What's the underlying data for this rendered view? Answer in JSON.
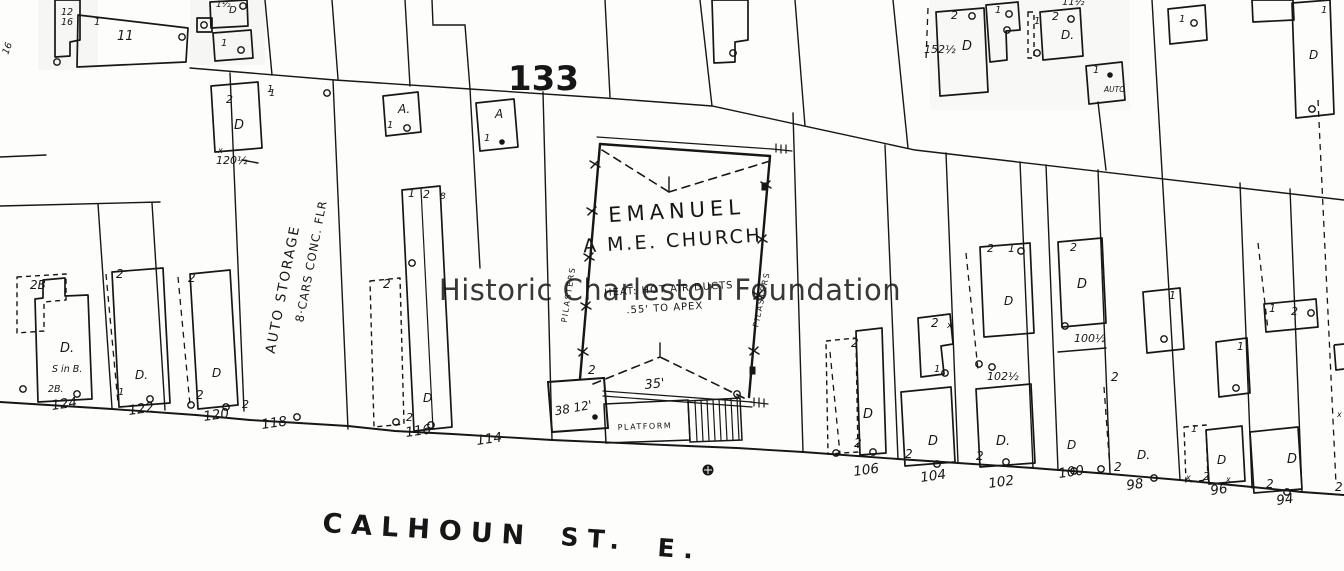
{
  "ink_color": "#161616",
  "watermark": {
    "text": "Historic Charleston Foundation",
    "color": "#8b9097"
  },
  "block_number": "133",
  "street": {
    "name": "CALHOUN",
    "abbrev": "ST.",
    "direction": "E."
  },
  "church": {
    "line1": "EMANUEL",
    "line2": "A M.E. CHURCH",
    "note1": "HEAT: HOT AIR DUCTS",
    "note2": ".55' TO APEX",
    "front_dim": "35'",
    "rear_building_dim": "38 12'",
    "platform_label": "PLATFORM",
    "wall_label_left": "PILASTERS",
    "wall_label_right": "PILASTERS",
    "porch_note": "2"
  },
  "auto_storage": {
    "line1": "AUTO STORAGE",
    "line2": "8·CARS CONC. FLR"
  },
  "street_numbers": [
    {
      "text": "124",
      "x": 52,
      "y": 410
    },
    {
      "text": "122",
      "x": 129,
      "y": 415
    },
    {
      "text": "120",
      "x": 204,
      "y": 421
    },
    {
      "text": "118",
      "x": 262,
      "y": 429
    },
    {
      "text": "116",
      "x": 406,
      "y": 437
    },
    {
      "text": "114",
      "x": 477,
      "y": 445
    },
    {
      "text": "106",
      "x": 854,
      "y": 476
    },
    {
      "text": "104",
      "x": 921,
      "y": 482
    },
    {
      "text": "102",
      "x": 989,
      "y": 488
    },
    {
      "text": "100",
      "x": 1059,
      "y": 478
    },
    {
      "text": "98",
      "x": 1127,
      "y": 490
    },
    {
      "text": "96",
      "x": 1211,
      "y": 495
    },
    {
      "text": "94",
      "x": 1277,
      "y": 505
    }
  ],
  "lot_labels": [
    {
      "text": "2B",
      "x": 30,
      "y": 289,
      "fs": 12
    },
    {
      "text": "D.",
      "x": 60,
      "y": 352,
      "fs": 13
    },
    {
      "text": "S in B.",
      "x": 52,
      "y": 372,
      "fs": 9.5
    },
    {
      "text": "2B.",
      "x": 48,
      "y": 392,
      "fs": 9.5
    },
    {
      "text": "2",
      "x": 116,
      "y": 278,
      "fs": 12
    },
    {
      "text": "2",
      "x": 188,
      "y": 282,
      "fs": 12
    },
    {
      "text": "D.",
      "x": 135,
      "y": 379,
      "fs": 12
    },
    {
      "text": "1",
      "x": 118,
      "y": 395,
      "fs": 10
    },
    {
      "text": "D",
      "x": 212,
      "y": 377,
      "fs": 12
    },
    {
      "text": "2",
      "x": 196,
      "y": 399,
      "fs": 12
    },
    {
      "text": "2",
      "x": 242,
      "y": 408,
      "fs": 11
    },
    {
      "text": "1",
      "x": 267,
      "y": 92,
      "fs": 10
    },
    {
      "text": "A.",
      "x": 398,
      "y": 113,
      "fs": 12
    },
    {
      "text": "1",
      "x": 387,
      "y": 128,
      "fs": 10
    },
    {
      "text": "A",
      "x": 495,
      "y": 118,
      "fs": 12
    },
    {
      "text": "1",
      "x": 484,
      "y": 141,
      "fs": 10
    },
    {
      "text": "1",
      "x": 408,
      "y": 197,
      "fs": 11
    },
    {
      "text": "2",
      "x": 423,
      "y": 198,
      "fs": 11
    },
    {
      "text": "8",
      "x": 440,
      "y": 199,
      "fs": 9
    },
    {
      "text": "2",
      "x": 383,
      "y": 288,
      "fs": 12
    },
    {
      "text": "D",
      "x": 423,
      "y": 402,
      "fs": 12
    },
    {
      "text": "2",
      "x": 406,
      "y": 421,
      "fs": 11
    },
    {
      "text": "2",
      "x": 851,
      "y": 347,
      "fs": 12
    },
    {
      "text": "D",
      "x": 863,
      "y": 418,
      "fs": 13
    },
    {
      "text": "2",
      "x": 854,
      "y": 447,
      "fs": 12
    },
    {
      "text": "2",
      "x": 931,
      "y": 327,
      "fs": 12
    },
    {
      "text": "x",
      "x": 947,
      "y": 328,
      "fs": 9
    },
    {
      "text": "1",
      "x": 934,
      "y": 372,
      "fs": 10
    },
    {
      "text": "D",
      "x": 928,
      "y": 445,
      "fs": 13
    },
    {
      "text": "2",
      "x": 905,
      "y": 458,
      "fs": 12
    },
    {
      "text": "2",
      "x": 987,
      "y": 252,
      "fs": 11
    },
    {
      "text": "1",
      "x": 1008,
      "y": 252,
      "fs": 11
    },
    {
      "text": "D",
      "x": 1004,
      "y": 305,
      "fs": 12
    },
    {
      "text": "102½",
      "x": 987,
      "y": 380,
      "fs": 11
    },
    {
      "text": "D.",
      "x": 996,
      "y": 445,
      "fs": 13
    },
    {
      "text": "2",
      "x": 976,
      "y": 460,
      "fs": 12
    },
    {
      "text": "2",
      "x": 1070,
      "y": 251,
      "fs": 11
    },
    {
      "text": "D",
      "x": 1077,
      "y": 288,
      "fs": 13
    },
    {
      "text": "100½",
      "x": 1074,
      "y": 342,
      "fs": 11
    },
    {
      "text": "D",
      "x": 1067,
      "y": 449,
      "fs": 12
    },
    {
      "text": "2",
      "x": 1114,
      "y": 471,
      "fs": 12
    },
    {
      "text": "D.",
      "x": 1137,
      "y": 459,
      "fs": 12
    },
    {
      "text": "2",
      "x": 1111,
      "y": 381,
      "fs": 12
    },
    {
      "text": "1",
      "x": 1169,
      "y": 299,
      "fs": 11
    },
    {
      "text": "1",
      "x": 1191,
      "y": 432,
      "fs": 10
    },
    {
      "text": "D",
      "x": 1217,
      "y": 464,
      "fs": 12
    },
    {
      "text": "2",
      "x": 1203,
      "y": 480,
      "fs": 11
    },
    {
      "text": "x",
      "x": 1186,
      "y": 480,
      "fs": 8
    },
    {
      "text": "x",
      "x": 1226,
      "y": 482,
      "fs": 8
    },
    {
      "text": "1",
      "x": 1237,
      "y": 350,
      "fs": 11
    },
    {
      "text": "1",
      "x": 1269,
      "y": 312,
      "fs": 11
    },
    {
      "text": "2",
      "x": 1291,
      "y": 315,
      "fs": 11
    },
    {
      "text": "D",
      "x": 1287,
      "y": 463,
      "fs": 13
    },
    {
      "text": "2",
      "x": 1266,
      "y": 488,
      "fs": 12
    },
    {
      "text": "2",
      "x": 1335,
      "y": 491,
      "fs": 12
    },
    {
      "text": "x",
      "x": 1337,
      "y": 417,
      "fs": 8
    },
    {
      "text": "152½",
      "x": 924,
      "y": 53,
      "fs": 11
    },
    {
      "text": "2",
      "x": 951,
      "y": 19,
      "fs": 11
    },
    {
      "text": "D",
      "x": 962,
      "y": 50,
      "fs": 13
    },
    {
      "text": "1",
      "x": 995,
      "y": 13,
      "fs": 10
    },
    {
      "text": "11½",
      "x": 1062,
      "y": 5,
      "fs": 10
    },
    {
      "text": "1",
      "x": 1034,
      "y": 24,
      "fs": 10
    },
    {
      "text": "2",
      "x": 1052,
      "y": 20,
      "fs": 11
    },
    {
      "text": "D.",
      "x": 1061,
      "y": 39,
      "fs": 12
    },
    {
      "text": "1",
      "x": 1093,
      "y": 73,
      "fs": 10
    },
    {
      "text": "AUTO",
      "x": 1104,
      "y": 92,
      "fs": 7.5
    },
    {
      "text": "1",
      "x": 1179,
      "y": 22,
      "fs": 10
    },
    {
      "text": "D",
      "x": 1309,
      "y": 59,
      "fs": 12
    },
    {
      "text": "1",
      "x": 1321,
      "y": 13,
      "fs": 10
    },
    {
      "text": "12",
      "x": 61,
      "y": 15,
      "fs": 9.5
    },
    {
      "text": "16",
      "x": 61,
      "y": 25,
      "fs": 9.5
    },
    {
      "text": "16",
      "x": 8,
      "y": 55,
      "fs": 9.5,
      "rot": -70
    },
    {
      "text": "1",
      "x": 94,
      "y": 25,
      "fs": 10
    },
    {
      "text": "11",
      "x": 117,
      "y": 40,
      "fs": 13
    },
    {
      "text": "1½",
      "x": 216,
      "y": 7,
      "fs": 9
    },
    {
      "text": "D",
      "x": 229,
      "y": 13,
      "fs": 10
    },
    {
      "text": "1",
      "x": 221,
      "y": 46,
      "fs": 10
    },
    {
      "text": "2",
      "x": 226,
      "y": 103,
      "fs": 11
    },
    {
      "text": "D",
      "x": 234,
      "y": 129,
      "fs": 13
    },
    {
      "text": "1",
      "x": 269,
      "y": 96,
      "fs": 10
    },
    {
      "text": "x",
      "x": 218,
      "y": 153,
      "fs": 8
    },
    {
      "text": "120½",
      "x": 216,
      "y": 164,
      "fs": 11
    }
  ],
  "circle_marks": [
    [
      182,
      37
    ],
    [
      57,
      62
    ],
    [
      23,
      389
    ],
    [
      77,
      394
    ],
    [
      150,
      399
    ],
    [
      191,
      405
    ],
    [
      226,
      407
    ],
    [
      297,
      417
    ],
    [
      327,
      93
    ],
    [
      407,
      128
    ],
    [
      412,
      263
    ],
    [
      396,
      422
    ],
    [
      431,
      425
    ],
    [
      836,
      453
    ],
    [
      873,
      452
    ],
    [
      945,
      373
    ],
    [
      937,
      464
    ],
    [
      979,
      364
    ],
    [
      992,
      367
    ],
    [
      1006,
      462
    ],
    [
      1021,
      251
    ],
    [
      1065,
      326
    ],
    [
      1074,
      471
    ],
    [
      1101,
      469
    ],
    [
      1154,
      478
    ],
    [
      1164,
      339
    ],
    [
      1236,
      388
    ],
    [
      1287,
      492
    ],
    [
      1311,
      313
    ],
    [
      972,
      16
    ],
    [
      1009,
      14
    ],
    [
      1007,
      30
    ],
    [
      1071,
      19
    ],
    [
      1037,
      53
    ],
    [
      1194,
      23
    ],
    [
      1312,
      109
    ],
    [
      733,
      53
    ],
    [
      737,
      394
    ],
    [
      243,
      6
    ],
    [
      204,
      25
    ],
    [
      241,
      50
    ]
  ],
  "dot_marks": [
    [
      502,
      142
    ],
    [
      595,
      417
    ],
    [
      1110,
      75
    ]
  ],
  "hydrant": {
    "x": 708,
    "y": 470
  }
}
